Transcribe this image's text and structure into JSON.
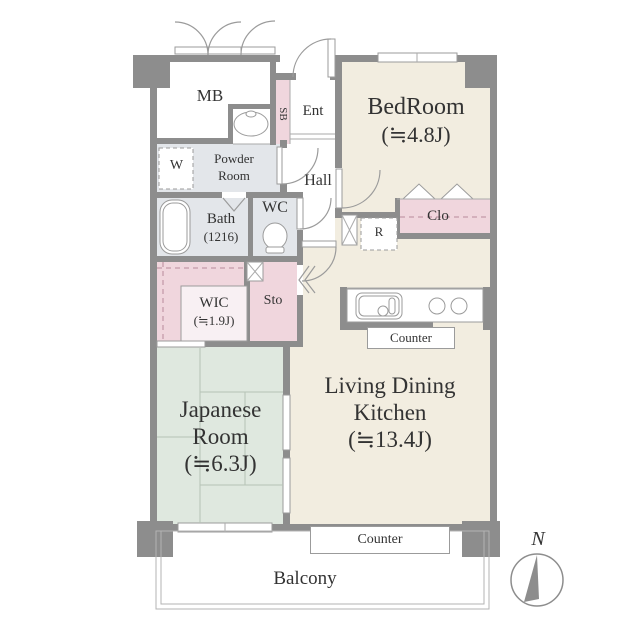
{
  "palette": {
    "wall_gray": "#8d8d8d",
    "room_beige": "#f2ede0",
    "room_green": "#dfe8df",
    "room_pink": "#f0d6dd",
    "room_gray": "#e3e6ea",
    "text_color": "#333333"
  },
  "floor_plan": {
    "rooms": {
      "meter_box": {
        "label": "MB"
      },
      "shoe_box": {
        "label": "SB"
      },
      "entrance": {
        "label": "Ent"
      },
      "bedroom": {
        "name": "BedRoom",
        "area": "(≒4.8J)"
      },
      "powder_room": {
        "line1": "Powder",
        "line2": "Room"
      },
      "washing_machine": {
        "label": "W"
      },
      "hall": {
        "label": "Hall"
      },
      "wc": {
        "label": "WC"
      },
      "bath": {
        "name": "Bath",
        "size": "(1216)"
      },
      "wic": {
        "name": "WIC",
        "area": "(≒1.9J)"
      },
      "storage": {
        "label": "Sto"
      },
      "refrigerator": {
        "label": "R"
      },
      "closet": {
        "label": "Clo"
      },
      "kitchen_counter": {
        "label": "Counter"
      },
      "living_dining_kitchen": {
        "line1": "Living Dining",
        "line2": "Kitchen",
        "area": "(≒13.4J)"
      },
      "japanese_room": {
        "line1": "Japanese",
        "line2": "Room",
        "area": "(≒6.3J)"
      },
      "window_counter": {
        "label": "Counter"
      },
      "balcony": {
        "label": "Balcony"
      }
    },
    "compass": {
      "north": "N"
    }
  }
}
